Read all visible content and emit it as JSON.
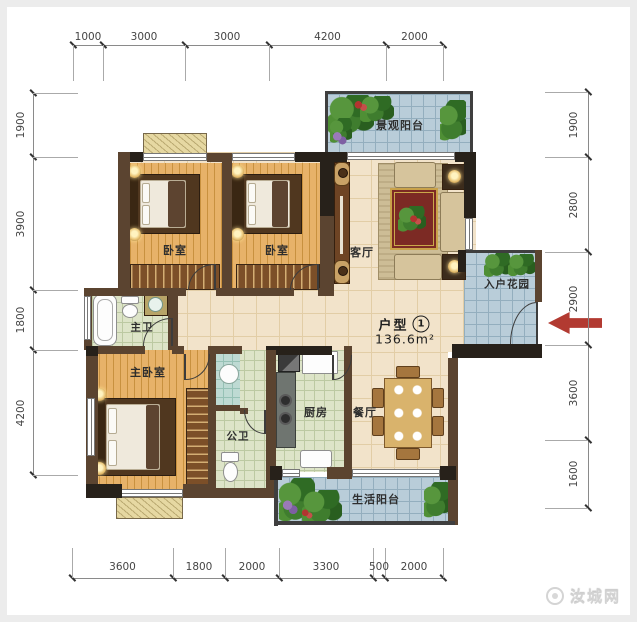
{
  "unit": {
    "label": "户型",
    "number": "1",
    "area": "136.6m²"
  },
  "watermark": {
    "text": "汝城网"
  },
  "rooms": {
    "view_balcony": "景观阳台",
    "bedroom_left": "卧室",
    "bedroom_mid": "卧室",
    "living": "客厅",
    "entry_garden": "入户花园",
    "master_bath": "主卫",
    "master_bedroom": "主卧室",
    "public_bath": "公卫",
    "kitchen": "厨房",
    "dining": "餐厅",
    "service_balcony": "生活阳台"
  },
  "dims": {
    "top": [
      "1000",
      "3000",
      "3000",
      "4200",
      "2000"
    ],
    "bottom": [
      "3600",
      "1800",
      "2000",
      "3300",
      "500",
      "2000"
    ],
    "left": [
      "1900",
      "3900",
      "1800",
      "4200"
    ],
    "right": [
      "1900",
      "2800",
      "2900",
      "3600",
      "1600"
    ]
  },
  "colors": {
    "wall": "#5b4430",
    "wall_dark": "#27211a",
    "wood_floor": "#e7b269",
    "tile_cream": "#f2e3ca",
    "tile_blue": "#b9cdd9",
    "tile_green": "#dde4c8",
    "arrow_red": "#b23a31"
  }
}
